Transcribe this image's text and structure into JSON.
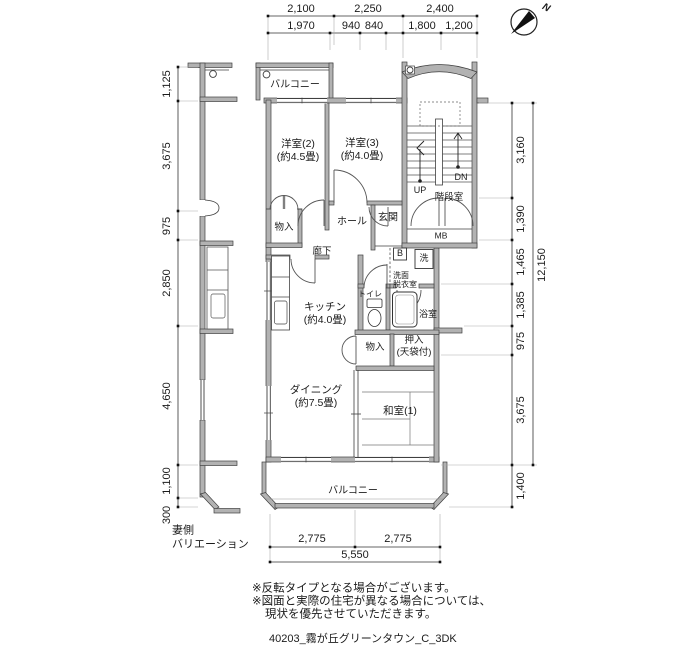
{
  "page": {
    "footer": "40203_霧が丘グリーンタウン_C_3DK"
  },
  "compass": {
    "label": "N"
  },
  "dims": {
    "top1": [
      "2,100",
      "2,250",
      "2,400"
    ],
    "top2": [
      "1,970",
      "940",
      "840",
      "1,800",
      "1,200"
    ],
    "left": [
      "1,125",
      "3,675",
      "975",
      "2,850",
      "4,650",
      "1,100",
      "300"
    ],
    "right": [
      "3,160",
      "1,390",
      "1,465",
      "1,385",
      "975",
      "3,675",
      "1,400"
    ],
    "right_total": "12,150",
    "bottom": [
      "2,775",
      "2,775"
    ],
    "bottom_total": "5,550"
  },
  "rooms": {
    "balcony_top": "バルコニー",
    "bedroom2": "洋室(2)",
    "bedroom2_size": "(約4.5畳)",
    "bedroom3": "洋室(3)",
    "bedroom3_size": "(約4.0畳)",
    "stairwell": "階段室",
    "hall": "ホール",
    "entrance": "玄関",
    "closet_upper": "物入",
    "corridor": "廊下",
    "washroom1": "洗面",
    "washroom2": "脱衣室",
    "kitchen": "キッチン",
    "kitchen_size": "(約4.0畳)",
    "toilet": "トイレ",
    "bathroom": "浴室",
    "closet_lower": "物入",
    "oshiire": "押入",
    "oshiire_note": "(天袋付)",
    "dining": "ダイニング",
    "dining_size": "(約7.5畳)",
    "washitsu": "和室(1)",
    "balcony_bottom": "バルコニー"
  },
  "labels": {
    "up": "UP",
    "down": "DN",
    "mb": "MB",
    "b": "B",
    "washer": "洗"
  },
  "side_note": {
    "line1": "妻側",
    "line2": "バリエーション"
  },
  "notes": {
    "line1": "※反転タイプとなる場合がございます。",
    "line2": "※図面と実際の住宅が異なる場合については、",
    "line3": "現状を優先させていただきます。"
  },
  "colors": {
    "wall_fill": "#b2b2b2",
    "line": "#3f3f3f",
    "text": "#1b1b1b",
    "background": "#ffffff"
  }
}
